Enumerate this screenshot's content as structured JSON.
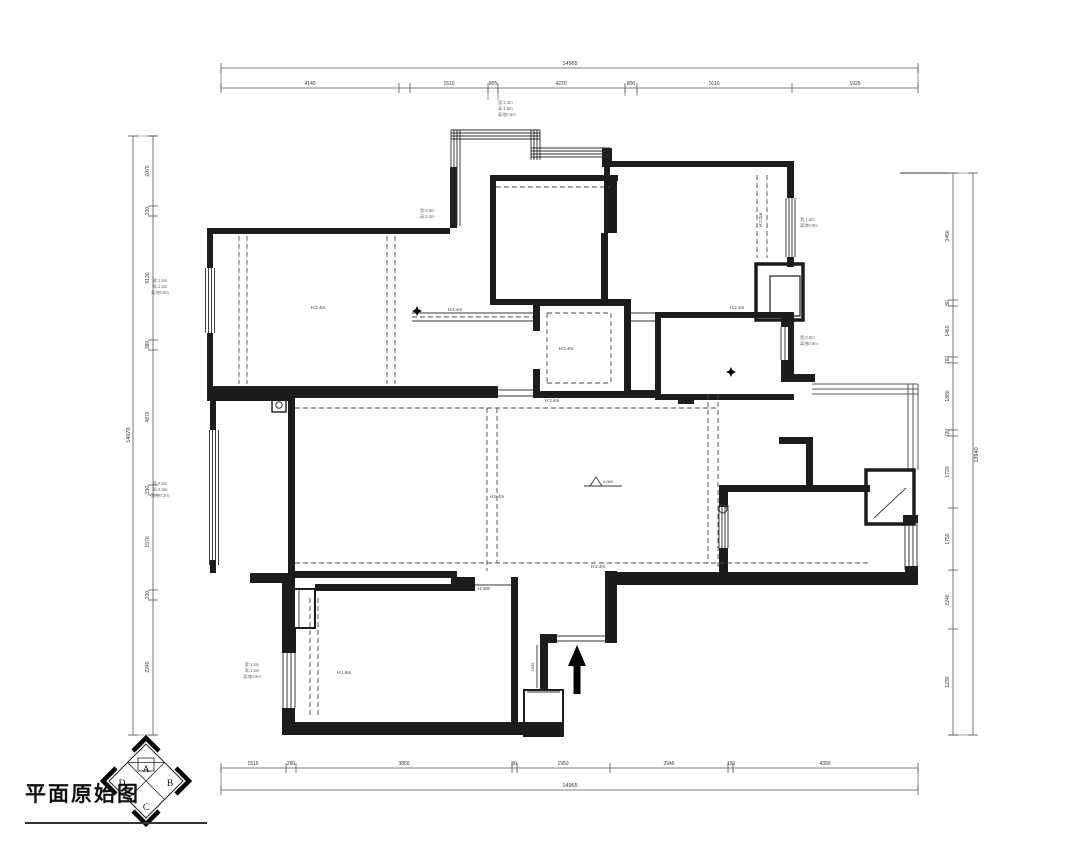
{
  "title": {
    "text": "平面原始图"
  },
  "compass": {
    "center": [
      146,
      781
    ],
    "radius": 37,
    "letters": [
      {
        "t": "A",
        "x": 146,
        "y": 772
      },
      {
        "t": "B",
        "x": 170,
        "y": 786
      },
      {
        "t": "C",
        "x": 146,
        "y": 810
      },
      {
        "t": "D",
        "x": 122,
        "y": 786
      }
    ]
  },
  "colors": {
    "wall": "#1c1c1c",
    "thin": "#333333",
    "dash": "#4a4a4a",
    "window": "#2a2a2a",
    "rail": "#5a5a5a",
    "dim": "#555555",
    "dimtext": "#333333",
    "anno": "#666666"
  },
  "dims": {
    "top": {
      "axis": "x",
      "main": 88,
      "total": 68,
      "from": 221,
      "to": 918,
      "ticks": [
        221,
        399,
        410,
        488,
        498,
        625,
        637,
        792,
        918
      ],
      "labels": [
        [
          310,
          "4140"
        ],
        [
          449,
          "1510"
        ],
        [
          493,
          "805"
        ],
        [
          561,
          "4220"
        ],
        [
          631,
          "800"
        ],
        [
          714,
          "1610"
        ],
        [
          855,
          "1925"
        ]
      ],
      "total_label": [
        570,
        "14965"
      ],
      "leaders": [
        [
          488,
          88,
          488,
          100
        ],
        [
          498,
          88,
          498,
          100
        ],
        [
          625,
          88,
          625,
          96
        ],
        [
          637,
          88,
          637,
          96
        ]
      ]
    },
    "bottom": {
      "axis": "x",
      "main": 768,
      "total": 790,
      "from": 221,
      "to": 918,
      "ticks": [
        221,
        286,
        296,
        512,
        517,
        610,
        728,
        733,
        918
      ],
      "labels": [
        [
          253,
          "1510"
        ],
        [
          291,
          "260"
        ],
        [
          404,
          "3850"
        ],
        [
          514,
          "80"
        ],
        [
          563,
          "1950"
        ],
        [
          669,
          "2940"
        ],
        [
          731,
          "120"
        ],
        [
          825,
          "4350"
        ]
      ],
      "total_label": [
        570,
        "14965"
      ],
      "leaders": []
    },
    "left": {
      "axis": "y",
      "main": 153,
      "total": 133,
      "from": 136,
      "to": 735,
      "ticks": [
        136,
        206,
        216,
        340,
        350,
        485,
        495,
        590,
        600,
        735
      ],
      "labels": [
        [
          171,
          "2070"
        ],
        [
          211,
          "230"
        ],
        [
          278,
          "5130"
        ],
        [
          345,
          "380"
        ],
        [
          417,
          "4870"
        ],
        [
          490,
          "330"
        ],
        [
          542,
          "1570"
        ],
        [
          595,
          "230"
        ],
        [
          667,
          "2240"
        ]
      ],
      "total_label": [
        435,
        "14070"
      ],
      "leaders": []
    },
    "right": {
      "axis": "y",
      "main": 953,
      "total": 973,
      "from": 173,
      "to": 735,
      "ticks": [
        173,
        300,
        306,
        357,
        363,
        430,
        436,
        508,
        570,
        629,
        735
      ],
      "labels": [
        [
          236,
          "3450"
        ],
        [
          303,
          "80"
        ],
        [
          331,
          "1460"
        ],
        [
          360,
          "160"
        ],
        [
          396,
          "1880"
        ],
        [
          433,
          "120"
        ],
        [
          472,
          "1720"
        ],
        [
          539,
          "1750"
        ],
        [
          600,
          "2240"
        ],
        [
          682,
          "1230"
        ]
      ],
      "total_label": [
        455,
        "13940"
      ],
      "leaders": []
    }
  },
  "plan": {
    "walls": [
      [
        207,
        228,
        243,
        6
      ],
      [
        450,
        167,
        7,
        61
      ],
      [
        207,
        234,
        6,
        34
      ],
      [
        207,
        333,
        6,
        53
      ],
      [
        207,
        386,
        291,
        12
      ],
      [
        533,
        391,
        98,
        7
      ],
      [
        631,
        390,
        26,
        8
      ],
      [
        490,
        175,
        128,
        6
      ],
      [
        490,
        181,
        6,
        118
      ],
      [
        490,
        299,
        49,
        6
      ],
      [
        610,
        175,
        7,
        58
      ],
      [
        601,
        233,
        7,
        66
      ],
      [
        602,
        148,
        10,
        19
      ],
      [
        604,
        161,
        190,
        6
      ],
      [
        604,
        167,
        6,
        66
      ],
      [
        787,
        167,
        7,
        31
      ],
      [
        787,
        257,
        7,
        10
      ],
      [
        655,
        312,
        139,
        6
      ],
      [
        655,
        318,
        6,
        82
      ],
      [
        655,
        394,
        139,
        6
      ],
      [
        678,
        394,
        16,
        10
      ],
      [
        788,
        318,
        6,
        60
      ],
      [
        781,
        318,
        13,
        9
      ],
      [
        781,
        360,
        13,
        17
      ],
      [
        781,
        374,
        34,
        8
      ],
      [
        533,
        299,
        98,
        7
      ],
      [
        624,
        306,
        7,
        85
      ],
      [
        533,
        306,
        7,
        25
      ],
      [
        533,
        369,
        7,
        22
      ],
      [
        288,
        398,
        7,
        175
      ],
      [
        207,
        395,
        85,
        6
      ],
      [
        210,
        401,
        6,
        29
      ],
      [
        210,
        560,
        6,
        13
      ],
      [
        250,
        573,
        45,
        10
      ],
      [
        288,
        571,
        169,
        7
      ],
      [
        451,
        577,
        24,
        14
      ],
      [
        315,
        584,
        160,
        7
      ],
      [
        511,
        577,
        7,
        147
      ],
      [
        605,
        571,
        12,
        72
      ],
      [
        540,
        634,
        17,
        9
      ],
      [
        540,
        643,
        8,
        47
      ],
      [
        282,
        722,
        281,
        13
      ],
      [
        282,
        583,
        13,
        70
      ],
      [
        282,
        708,
        13,
        14
      ],
      [
        284,
        628,
        12,
        25
      ],
      [
        728,
        485,
        142,
        7
      ],
      [
        719,
        485,
        9,
        22
      ],
      [
        719,
        548,
        9,
        26
      ],
      [
        611,
        572,
        307,
        13
      ],
      [
        905,
        566,
        13,
        8
      ],
      [
        903,
        515,
        15,
        8
      ],
      [
        806,
        440,
        7,
        46
      ],
      [
        779,
        437,
        34,
        7
      ]
    ],
    "windows": [
      [
        205.5,
        268,
        65,
        "v",
        4,
        3
      ],
      [
        209.5,
        430,
        135,
        "v",
        4,
        3
      ],
      [
        283,
        653,
        55,
        "v",
        4,
        4
      ],
      [
        786,
        198,
        59,
        "v",
        4,
        3
      ],
      [
        781,
        327,
        33,
        "v",
        4,
        4
      ],
      [
        719,
        505,
        43,
        "v",
        4,
        3
      ],
      [
        905,
        522,
        48,
        "v",
        4,
        4
      ],
      [
        451,
        130,
        96,
        "v",
        4,
        3
      ],
      [
        451,
        130,
        89,
        "h",
        4,
        3
      ],
      [
        531,
        130,
        30,
        "v",
        4,
        3
      ],
      [
        531,
        148,
        79,
        "h",
        4,
        3
      ]
    ],
    "railings": [
      [
        812,
        384,
        106,
        "h",
        3,
        5
      ],
      [
        908,
        384,
        86,
        "v",
        3,
        5
      ]
    ],
    "srects": [
      [
        756,
        264,
        47,
        56,
        3.5
      ],
      [
        770,
        276,
        30,
        40,
        1.2
      ],
      [
        284,
        589,
        31,
        39,
        2
      ],
      [
        524,
        690,
        39,
        46,
        2
      ],
      [
        272,
        399,
        14,
        13,
        1.4
      ],
      [
        866,
        470,
        48,
        54,
        3.5
      ]
    ],
    "lines": [
      [
        412,
        313,
        533,
        313
      ],
      [
        412,
        321,
        533,
        321
      ],
      [
        631,
        313,
        655,
        313
      ],
      [
        631,
        321,
        655,
        321
      ],
      [
        299,
        589,
        299,
        628
      ],
      [
        557,
        636,
        605,
        636
      ],
      [
        557,
        641,
        605,
        641
      ],
      [
        475,
        585,
        511,
        585
      ],
      [
        498,
        390,
        533,
        390
      ],
      [
        498,
        396,
        533,
        396
      ],
      [
        584,
        486,
        622,
        486
      ],
      [
        537,
        645,
        537,
        688
      ],
      [
        527,
        692,
        560,
        692
      ],
      [
        874,
        518,
        906,
        488
      ],
      [
        900,
        173,
        953,
        173
      ]
    ],
    "dashed": [
      [
        295,
        408,
        716,
        408
      ],
      [
        295,
        563,
        868,
        563
      ],
      [
        487,
        408,
        487,
        571
      ],
      [
        497,
        408,
        497,
        563
      ],
      [
        708,
        394,
        708,
        563
      ],
      [
        718,
        394,
        718,
        570
      ],
      [
        239,
        236,
        239,
        384
      ],
      [
        247,
        236,
        247,
        384
      ],
      [
        387,
        236,
        387,
        384
      ],
      [
        395,
        236,
        395,
        384
      ],
      [
        757,
        175,
        757,
        258
      ],
      [
        767,
        175,
        767,
        258
      ],
      [
        547,
        313,
        611,
        313
      ],
      [
        547,
        383,
        611,
        383
      ],
      [
        547,
        313,
        547,
        383
      ],
      [
        611,
        313,
        611,
        383
      ],
      [
        310,
        598,
        310,
        718
      ],
      [
        318,
        598,
        318,
        718
      ],
      [
        412,
        317,
        533,
        317
      ],
      [
        496,
        187,
        610,
        187
      ]
    ],
    "circles": [
      [
        279,
        405,
        3.2
      ],
      [
        723,
        509,
        4
      ]
    ],
    "stars": [
      [
        417,
        311
      ],
      [
        731,
        372
      ]
    ],
    "arrow": [
      [
        577,
        645
      ],
      [
        568,
        666
      ],
      [
        573.5,
        666
      ],
      [
        573.5,
        694
      ],
      [
        580.5,
        694
      ],
      [
        580.5,
        666
      ],
      [
        586,
        666
      ]
    ],
    "level": {
      "tri": [
        [
          590,
          486
        ],
        [
          596,
          477
        ],
        [
          602,
          486
        ]
      ],
      "text": "0.000",
      "tx": 603,
      "ty": 483
    },
    "texts": [
      [
        "H:2.4m",
        318,
        309,
        4.5,
        "dim",
        0,
        "middle"
      ],
      [
        "H:2.4m",
        737,
        309,
        4.5,
        "dim",
        0,
        "middle"
      ],
      [
        "H:2.2m",
        762,
        220,
        4.5,
        "dim",
        -90,
        "middle"
      ],
      [
        "H:2.4m",
        566,
        350,
        4.5,
        "dim",
        0,
        "middle"
      ],
      [
        "H:2.4m",
        552,
        402,
        4.5,
        "dim",
        0,
        "middle"
      ],
      [
        "H:2.4m",
        598,
        568,
        4.5,
        "dim",
        0,
        "middle"
      ],
      [
        "H:2.4m",
        497,
        498,
        4.5,
        "dim",
        0,
        "middle"
      ],
      [
        "H:1.8m",
        344,
        674,
        4.5,
        "dim",
        0,
        "middle"
      ],
      [
        "H:400",
        484,
        590,
        4.5,
        "dim",
        0,
        "middle"
      ],
      [
        "H:2.4m",
        455,
        311,
        4.5,
        "dim",
        0,
        "middle"
      ],
      [
        "宽:1.5m",
        160,
        282,
        4.2,
        "anno",
        0,
        "middle"
      ],
      [
        "高:1.5m",
        160,
        288,
        4.2,
        "anno",
        0,
        "middle"
      ],
      [
        "离地0.5m",
        160,
        294,
        4.2,
        "anno",
        0,
        "middle"
      ],
      [
        "宽:2.6m",
        160,
        485,
        4.2,
        "anno",
        0,
        "middle"
      ],
      [
        "高:2.0m",
        160,
        491,
        4.2,
        "anno",
        0,
        "middle"
      ],
      [
        "离地0.3m",
        160,
        497,
        4.2,
        "anno",
        0,
        "middle"
      ],
      [
        "宽:1.5m",
        252,
        666,
        4.2,
        "anno",
        0,
        "middle"
      ],
      [
        "高:1.5m",
        252,
        672,
        4.2,
        "anno",
        0,
        "middle"
      ],
      [
        "离地0.9m",
        252,
        678,
        4.2,
        "anno",
        0,
        "middle"
      ],
      [
        "宽:2.4m",
        498,
        104,
        4.2,
        "anno",
        0,
        "start"
      ],
      [
        "高:1.5m",
        498,
        110,
        4.2,
        "anno",
        0,
        "start"
      ],
      [
        "离地0.9m",
        498,
        116,
        4.2,
        "anno",
        0,
        "start"
      ],
      [
        "宽:1.6m",
        800,
        221,
        4.2,
        "anno",
        0,
        "start"
      ],
      [
        "离地0.9m",
        800,
        227,
        4.2,
        "anno",
        0,
        "start"
      ],
      [
        "宽:0.9m",
        800,
        339,
        4.2,
        "anno",
        0,
        "start"
      ],
      [
        "离地0.9m",
        800,
        345,
        4.2,
        "anno",
        0,
        "start"
      ],
      [
        "宽:0.9m",
        420,
        212,
        4.2,
        "anno",
        0,
        "start"
      ],
      [
        "高:2.0m",
        420,
        218,
        4.2,
        "anno",
        0,
        "start"
      ],
      [
        "1635",
        534,
        667,
        4,
        "dim",
        -90,
        "middle"
      ],
      [
        "850",
        543,
        690,
        4,
        "dim",
        0,
        "middle"
      ]
    ]
  }
}
